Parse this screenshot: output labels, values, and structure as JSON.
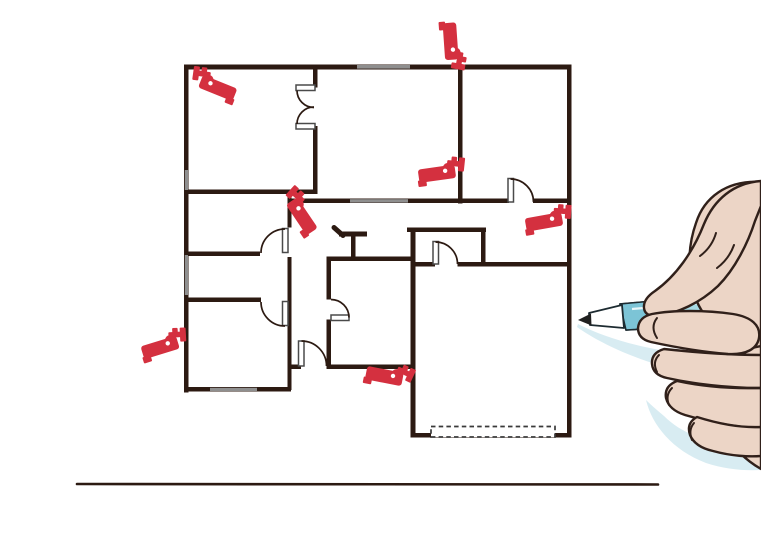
{
  "illustration": {
    "name": "floor-plan-with-security-cameras-and-hand-drawing",
    "text": ""
  },
  "colors": {
    "background": "#ffffff",
    "wall": "#2c1a12",
    "camera_red": "#d4303f",
    "window_gray": "#8f8f8f",
    "door_outline": "#4a4a4a",
    "dashed_stroke": "#3a3a3a",
    "skin": "#ecd5c6",
    "hand_outline": "#30201a",
    "pen_body_blue": "#a6d9e4",
    "pen_grip_blue": "#7cc4d6",
    "pen_outline": "#1d2b31",
    "pen_tip_white": "#ffffff",
    "pen_point_dark": "#202020",
    "shadow_blue": "#d8ecf2"
  },
  "floor_plan": {
    "walls": [
      [
        184,
        64.5,
        387.5,
        5
      ],
      [
        184,
        64.5,
        4.5,
        328
      ],
      [
        567,
        64.5,
        4.5,
        373
      ],
      [
        411,
        433,
        160.5,
        4.5
      ],
      [
        184,
        189.5,
        133,
        4.5
      ],
      [
        313,
        64.5,
        4.5,
        23
      ],
      [
        313,
        126,
        4.5,
        68
      ],
      [
        291,
        198.5,
        218,
        4.5
      ],
      [
        533,
        198.5,
        38,
        4.5
      ],
      [
        458,
        64.5,
        4.5,
        139
      ],
      [
        184,
        251.5,
        76,
        4.5
      ],
      [
        184,
        297.5,
        77,
        4.5
      ],
      [
        287.5,
        189.5,
        4,
        38
      ],
      [
        287.5,
        257,
        4,
        133
      ],
      [
        184,
        387,
        107,
        4.5
      ],
      [
        288,
        364.5,
        13,
        4.5
      ],
      [
        326.5,
        364.5,
        88,
        4.5
      ],
      [
        326.5,
        256.5,
        88,
        4.5
      ],
      [
        326.5,
        256.5,
        4.5,
        43
      ],
      [
        326.5,
        319.5,
        4.5,
        49.5
      ],
      [
        410.5,
        228,
        5,
        209.5
      ],
      [
        407,
        227.5,
        79,
        4.5
      ],
      [
        481,
        227.5,
        4.5,
        39
      ],
      [
        410.5,
        262,
        24.5,
        4.5
      ],
      [
        457.5,
        262,
        113.5,
        4.5
      ],
      [
        339,
        231.5,
        28,
        5
      ],
      [
        351,
        236,
        4.5,
        25
      ]
    ],
    "diagonal_walls": [
      [
        334,
        227.5,
        343,
        235.5
      ]
    ],
    "windows": [
      [
        357,
        65,
        53,
        3.6
      ],
      [
        350,
        199.2,
        58,
        3.4
      ],
      [
        184.8,
        255,
        3.2,
        40
      ],
      [
        184.8,
        170,
        3.2,
        20
      ],
      [
        210,
        387.8,
        47,
        3.2
      ]
    ],
    "door_leaves": [
      [
        296,
        85,
        19,
        5.5
      ],
      [
        296,
        123.5,
        19,
        5.5
      ],
      [
        282.5,
        228.5,
        5.5,
        24
      ],
      [
        282.5,
        301.5,
        5.5,
        24
      ],
      [
        298.5,
        341,
        5.5,
        25
      ],
      [
        331,
        315,
        18,
        5.5
      ],
      [
        508,
        178.5,
        5.5,
        23.5
      ],
      [
        433,
        241.5,
        5.5,
        22.5
      ]
    ],
    "door_arcs": [
      "M 297 90.5 A 17 17 0 0 0 314 107.5",
      "M 297 124 A 17 17 0 0 1 314 107",
      "M 285 229 A 24 24 0 0 0 261 253",
      "M 285 326 A 24 24 0 0 1 261 302",
      "M 301.5 341 A 25 25 0 0 1 326.5 366",
      "M 349 317.5 A 18 18 0 0 0 331 299.5",
      "M 510.5 179 A 23 23 0 0 1 533.5 202",
      "M 435.5 242 A 22 22 0 0 1 457.5 264"
    ],
    "garage_door_dashed": [
      431,
      426.5,
      124,
      10.5
    ],
    "ground_line": [
      77,
      484,
      658,
      484.5
    ]
  },
  "cameras": [
    {
      "name": "cctv-camera-icon",
      "glyph": "right",
      "transform": "translate(188,66) rotate(8 24 20)"
    },
    {
      "name": "cctv-camera-icon",
      "glyph": "left",
      "transform": "translate(424,24) rotate(100 25 22)"
    },
    {
      "name": "cctv-camera-icon",
      "glyph": "left",
      "transform": "translate(417,153) rotate(6 25 20)"
    },
    {
      "name": "cctv-camera-icon",
      "glyph": "right",
      "transform": "translate(284,186) rotate(42 12 10)"
    },
    {
      "name": "cctv-camera-icon",
      "glyph": "left",
      "transform": "translate(524,201) rotate(4 25 20)"
    },
    {
      "name": "cctv-camera-icon",
      "glyph": "left",
      "transform": "translate(140,326) rotate(-3 25 20)"
    },
    {
      "name": "cctv-camera-icon",
      "glyph": "left",
      "transform": "translate(365,366) rotate(25 45 14)"
    }
  ]
}
